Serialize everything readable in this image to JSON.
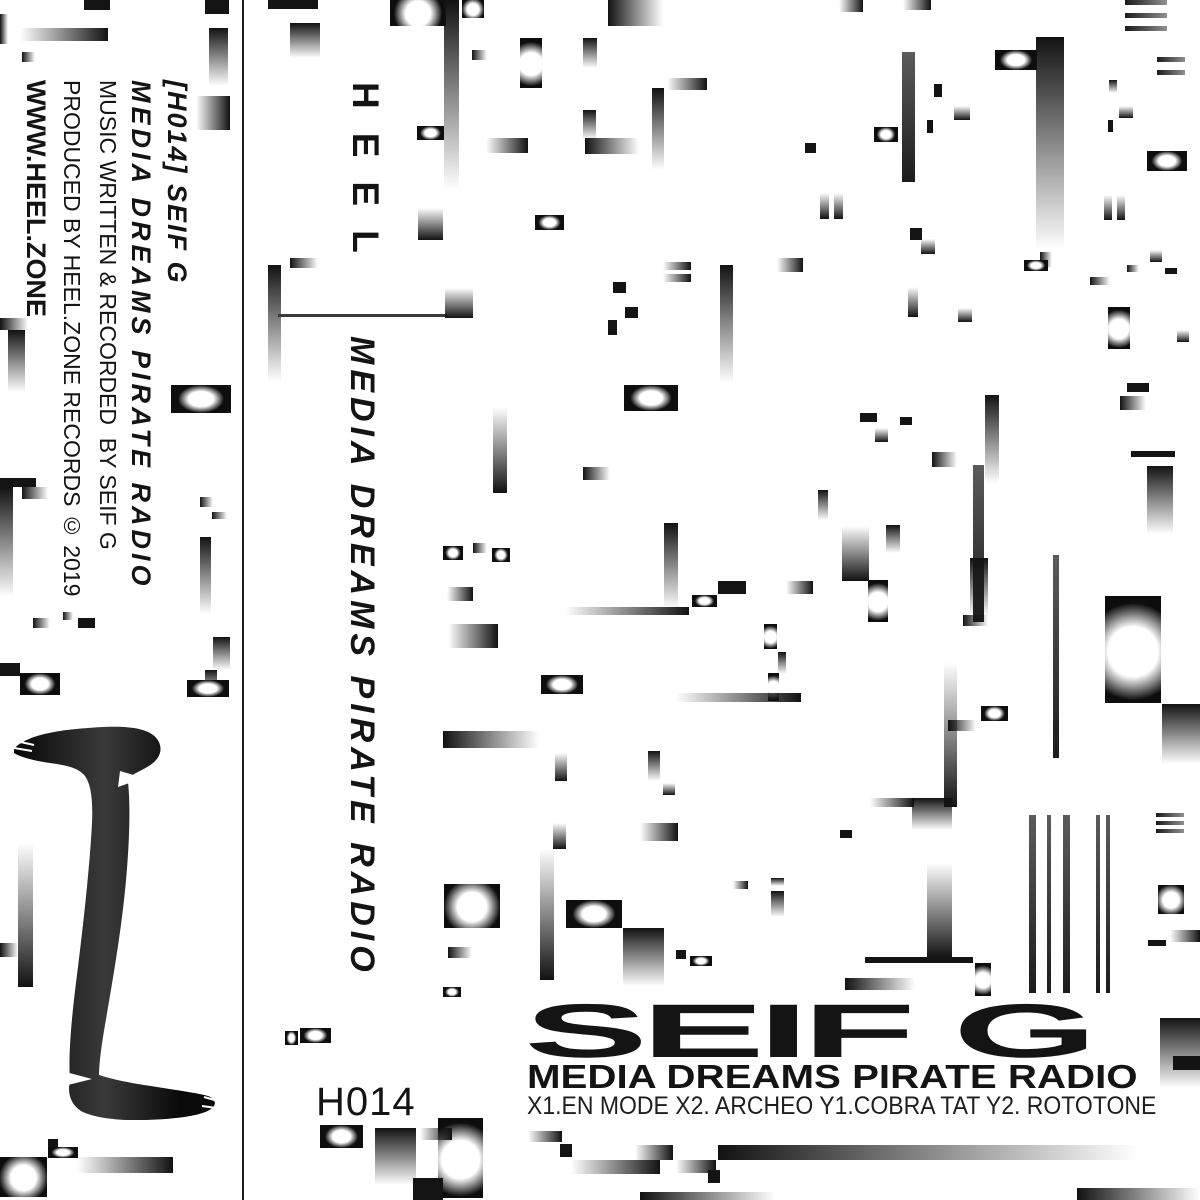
{
  "spine": {
    "catalog_artist": "[H014] SEIF G",
    "album": "MEDIA DREAMS PIRATE RADIO",
    "credit_music": "MUSIC WRITTEN & RECORDED  BY SEIF G",
    "credit_produced": "PRODUCED BY HEEL.ZONE RECORDS © 2019",
    "website": "WWW.HEEL.ZONE"
  },
  "front": {
    "logo": "HEEL",
    "album_vertical": "MEDIA DREAMS PIRATE RADIO",
    "catalog": "H014",
    "artist": "SEIF G",
    "album": "MEDIA DREAMS PIRATE RADIO",
    "tracklist": "X1.EN MODE X2. ARCHEO Y1.COBRA TAT Y2. ROTOTONE"
  },
  "colors": {
    "ink": "#141414",
    "background": "#ffffff"
  },
  "glitch_blocks": [
    [
      84,
      0,
      26,
      10,
      "sd"
    ],
    [
      205,
      0,
      24,
      14,
      "sd"
    ],
    [
      0,
      14,
      8,
      30,
      "hl"
    ],
    [
      20,
      28,
      88,
      13,
      "hr"
    ],
    [
      22,
      52,
      13,
      10,
      "hl"
    ],
    [
      209,
      28,
      19,
      58,
      "vt"
    ],
    [
      196,
      96,
      34,
      34,
      "hr"
    ],
    [
      0,
      318,
      28,
      12,
      "hl"
    ],
    [
      8,
      330,
      17,
      62,
      "vt"
    ],
    [
      171,
      385,
      60,
      28,
      "gw"
    ],
    [
      0,
      478,
      36,
      9,
      "sd"
    ],
    [
      0,
      487,
      13,
      110,
      "vt"
    ],
    [
      22,
      487,
      26,
      12,
      "hl"
    ],
    [
      200,
      497,
      13,
      10,
      "hl"
    ],
    [
      212,
      512,
      15,
      7,
      "hl"
    ],
    [
      200,
      537,
      11,
      77,
      "vt"
    ],
    [
      33,
      618,
      17,
      10,
      "hl"
    ],
    [
      63,
      612,
      10,
      8,
      "hl"
    ],
    [
      78,
      618,
      17,
      10,
      "sd"
    ],
    [
      213,
      637,
      17,
      33,
      "vt"
    ],
    [
      0,
      663,
      20,
      13,
      "sd"
    ],
    [
      20,
      673,
      40,
      22,
      "gw"
    ],
    [
      205,
      670,
      12,
      25,
      "vt"
    ],
    [
      187,
      680,
      42,
      17,
      "gw"
    ],
    [
      18,
      843,
      15,
      144,
      "vb"
    ],
    [
      0,
      943,
      18,
      14,
      "hl"
    ],
    [
      48,
      1139,
      10,
      8,
      "sd"
    ],
    [
      48,
      1147,
      30,
      11,
      "gw"
    ],
    [
      0,
      1157,
      47,
      40,
      "gc"
    ],
    [
      77,
      1157,
      96,
      16,
      "hr"
    ],
    [
      268,
      0,
      50,
      9,
      "sd"
    ],
    [
      290,
      23,
      30,
      35,
      "vt"
    ],
    [
      390,
      0,
      56,
      26,
      "gc"
    ],
    [
      462,
      0,
      22,
      18,
      "gc"
    ],
    [
      444,
      0,
      15,
      190,
      "vt"
    ],
    [
      472,
      50,
      15,
      10,
      "hl"
    ],
    [
      520,
      38,
      22,
      50,
      "gc"
    ],
    [
      583,
      38,
      14,
      30,
      "vt"
    ],
    [
      608,
      0,
      55,
      26,
      "hl"
    ],
    [
      667,
      78,
      40,
      12,
      "hr"
    ],
    [
      652,
      88,
      12,
      82,
      "vt"
    ],
    [
      583,
      110,
      13,
      30,
      "vt"
    ],
    [
      585,
      138,
      54,
      16,
      "hl"
    ],
    [
      486,
      138,
      42,
      15,
      "hr"
    ],
    [
      417,
      126,
      27,
      14,
      "gw"
    ],
    [
      535,
      215,
      29,
      15,
      "gw"
    ],
    [
      418,
      208,
      25,
      32,
      "vb"
    ],
    [
      290,
      258,
      28,
      10,
      "hl"
    ],
    [
      268,
      265,
      13,
      117,
      "vt"
    ],
    [
      278,
      314,
      169,
      3,
      "rl"
    ],
    [
      445,
      288,
      28,
      30,
      "vb"
    ],
    [
      839,
      0,
      24,
      12,
      "hr"
    ],
    [
      903,
      0,
      28,
      10,
      "hr"
    ],
    [
      934,
      84,
      8,
      13,
      "sd"
    ],
    [
      954,
      106,
      16,
      14,
      "vb"
    ],
    [
      927,
      120,
      6,
      13,
      "sd"
    ],
    [
      902,
      52,
      13,
      130,
      "lnv"
    ],
    [
      995,
      50,
      42,
      20,
      "gw"
    ],
    [
      1036,
      37,
      28,
      213,
      "vt"
    ],
    [
      874,
      127,
      24,
      15,
      "gw"
    ],
    [
      805,
      143,
      11,
      10,
      "sd"
    ],
    [
      820,
      193,
      9,
      26,
      "vb"
    ],
    [
      834,
      193,
      9,
      26,
      "vb"
    ],
    [
      910,
      228,
      12,
      12,
      "sd"
    ],
    [
      921,
      239,
      14,
      15,
      "vb"
    ],
    [
      908,
      287,
      10,
      30,
      "vb"
    ],
    [
      958,
      308,
      14,
      14,
      "vb"
    ],
    [
      1040,
      252,
      12,
      15,
      "hl"
    ],
    [
      1090,
      277,
      20,
      8,
      "hl"
    ],
    [
      1024,
      260,
      24,
      11,
      "gw"
    ],
    [
      1125,
      0,
      42,
      5,
      "ln"
    ],
    [
      1125,
      13,
      42,
      5,
      "ln"
    ],
    [
      1125,
      26,
      42,
      5,
      "ln"
    ],
    [
      1157,
      57,
      28,
      5,
      "ln"
    ],
    [
      1157,
      70,
      28,
      5,
      "ln"
    ],
    [
      1109,
      80,
      8,
      13,
      "vt"
    ],
    [
      1119,
      106,
      14,
      12,
      "vb"
    ],
    [
      1108,
      120,
      5,
      12,
      "sd"
    ],
    [
      1147,
      151,
      40,
      20,
      "gw"
    ],
    [
      1104,
      195,
      8,
      25,
      "vb"
    ],
    [
      1117,
      195,
      8,
      25,
      "vb"
    ],
    [
      1150,
      250,
      12,
      12,
      "vb"
    ],
    [
      1127,
      265,
      12,
      7,
      "hl"
    ],
    [
      1165,
      268,
      12,
      6,
      "sd"
    ],
    [
      1108,
      307,
      22,
      42,
      "gc"
    ],
    [
      1177,
      330,
      12,
      12,
      "vb"
    ],
    [
      1127,
      383,
      22,
      9,
      "sd"
    ],
    [
      663,
      262,
      28,
      8,
      "hr"
    ],
    [
      663,
      274,
      28,
      8,
      "hr"
    ],
    [
      613,
      282,
      13,
      11,
      "sd"
    ],
    [
      625,
      307,
      13,
      11,
      "sd"
    ],
    [
      608,
      320,
      9,
      15,
      "sd"
    ],
    [
      720,
      265,
      13,
      118,
      "vt"
    ],
    [
      777,
      258,
      26,
      14,
      "hr"
    ],
    [
      493,
      407,
      14,
      86,
      "vb"
    ],
    [
      624,
      385,
      54,
      26,
      "gw"
    ],
    [
      583,
      467,
      27,
      13,
      "hl"
    ],
    [
      443,
      546,
      20,
      14,
      "gw"
    ],
    [
      473,
      543,
      14,
      10,
      "hl"
    ],
    [
      492,
      548,
      18,
      14,
      "gw"
    ],
    [
      447,
      587,
      26,
      14,
      "hr"
    ],
    [
      664,
      523,
      14,
      86,
      "vt"
    ],
    [
      565,
      607,
      124,
      8,
      "hr"
    ],
    [
      718,
      581,
      28,
      13,
      "sd"
    ],
    [
      786,
      581,
      27,
      13,
      "hr"
    ],
    [
      692,
      595,
      25,
      12,
      "gw"
    ],
    [
      860,
      413,
      17,
      9,
      "sd"
    ],
    [
      900,
      417,
      12,
      8,
      "sd"
    ],
    [
      875,
      428,
      13,
      14,
      "vb"
    ],
    [
      932,
      452,
      25,
      15,
      "hl"
    ],
    [
      985,
      395,
      14,
      89,
      "vt"
    ],
    [
      973,
      465,
      11,
      157,
      "lnv"
    ],
    [
      818,
      490,
      10,
      30,
      "vt"
    ],
    [
      842,
      526,
      27,
      55,
      "vb"
    ],
    [
      886,
      525,
      14,
      28,
      "vt"
    ],
    [
      868,
      580,
      20,
      42,
      "gc"
    ],
    [
      1131,
      451,
      44,
      6,
      "sd"
    ],
    [
      1147,
      466,
      26,
      68,
      "vt"
    ],
    [
      1120,
      396,
      26,
      14,
      "hl"
    ],
    [
      970,
      558,
      18,
      58,
      "vt"
    ],
    [
      963,
      615,
      25,
      11,
      "hl"
    ],
    [
      944,
      662,
      13,
      145,
      "vb"
    ],
    [
      981,
      706,
      27,
      15,
      "gw"
    ],
    [
      948,
      720,
      28,
      11,
      "hl"
    ],
    [
      1053,
      555,
      6,
      203,
      "lnv"
    ],
    [
      1105,
      596,
      56,
      107,
      "gc"
    ],
    [
      1162,
      704,
      38,
      60,
      "vt"
    ],
    [
      448,
      624,
      50,
      24,
      "hr"
    ],
    [
      541,
      675,
      42,
      19,
      "gw"
    ],
    [
      764,
      624,
      13,
      25,
      "gc"
    ],
    [
      778,
      652,
      8,
      22,
      "vt"
    ],
    [
      768,
      673,
      11,
      28,
      "gc"
    ],
    [
      676,
      693,
      125,
      9,
      "hr"
    ],
    [
      443,
      731,
      96,
      17,
      "hl"
    ],
    [
      555,
      753,
      12,
      28,
      "vb"
    ],
    [
      648,
      751,
      12,
      30,
      "vt"
    ],
    [
      663,
      783,
      12,
      12,
      "vb"
    ],
    [
      553,
      823,
      13,
      26,
      "vb"
    ],
    [
      640,
      823,
      38,
      18,
      "hr"
    ],
    [
      771,
      878,
      13,
      8,
      "vt"
    ],
    [
      771,
      891,
      13,
      26,
      "vt"
    ],
    [
      733,
      881,
      15,
      8,
      "hr"
    ],
    [
      566,
      900,
      56,
      28,
      "gw"
    ],
    [
      444,
      884,
      56,
      44,
      "gc"
    ],
    [
      448,
      947,
      24,
      11,
      "hl"
    ],
    [
      623,
      928,
      41,
      58,
      "vt"
    ],
    [
      540,
      848,
      14,
      132,
      "vb"
    ],
    [
      676,
      950,
      10,
      9,
      "sd"
    ],
    [
      690,
      956,
      22,
      10,
      "gw"
    ],
    [
      443,
      987,
      18,
      10,
      "gw"
    ],
    [
      1029,
      815,
      7,
      178,
      "lnv"
    ],
    [
      1047,
      815,
      4,
      178,
      "lnv"
    ],
    [
      1063,
      815,
      7,
      178,
      "lnv"
    ],
    [
      1096,
      815,
      4,
      178,
      "lnv"
    ],
    [
      1106,
      815,
      4,
      178,
      "lnv"
    ],
    [
      912,
      798,
      40,
      32,
      "vt"
    ],
    [
      870,
      798,
      44,
      9,
      "hr"
    ],
    [
      840,
      830,
      12,
      8,
      "sd"
    ],
    [
      927,
      863,
      25,
      95,
      "vb"
    ],
    [
      865,
      957,
      108,
      6,
      "sd"
    ],
    [
      845,
      978,
      70,
      12,
      "hl"
    ],
    [
      975,
      963,
      16,
      33,
      "gc"
    ],
    [
      1158,
      885,
      26,
      29,
      "gc"
    ],
    [
      1170,
      930,
      30,
      12,
      "hr"
    ],
    [
      1148,
      940,
      18,
      6,
      "sd"
    ],
    [
      1156,
      813,
      28,
      4,
      "ln"
    ],
    [
      1156,
      821,
      28,
      4,
      "ln"
    ],
    [
      1156,
      829,
      28,
      4,
      "ln"
    ],
    [
      285,
      1031,
      13,
      14,
      "gw"
    ],
    [
      300,
      1028,
      31,
      15,
      "gw"
    ],
    [
      320,
      1125,
      43,
      23,
      "gw"
    ],
    [
      375,
      1128,
      41,
      57,
      "vt"
    ],
    [
      438,
      1118,
      45,
      80,
      "gc"
    ],
    [
      413,
      1178,
      30,
      22,
      "sd"
    ],
    [
      420,
      1128,
      32,
      12,
      "hr"
    ],
    [
      528,
      1131,
      34,
      11,
      "hr"
    ],
    [
      560,
      1144,
      12,
      13,
      "sd"
    ],
    [
      571,
      1160,
      89,
      14,
      "hr"
    ],
    [
      635,
      1145,
      38,
      15,
      "hr"
    ],
    [
      676,
      1160,
      40,
      13,
      "hr"
    ],
    [
      718,
      1145,
      420,
      15,
      "hl"
    ],
    [
      708,
      1170,
      12,
      13,
      "sd"
    ],
    [
      640,
      1192,
      135,
      8,
      "hl"
    ],
    [
      1077,
      1188,
      123,
      12,
      "hl"
    ],
    [
      1173,
      1056,
      27,
      14,
      "sd"
    ],
    [
      1160,
      1018,
      40,
      70,
      "vt"
    ]
  ]
}
